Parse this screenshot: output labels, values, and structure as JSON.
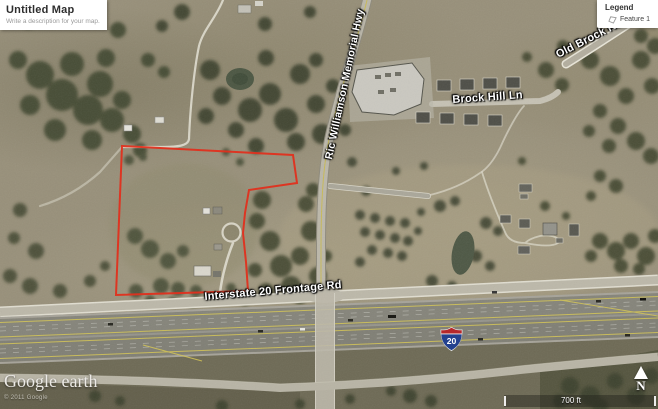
{
  "title_card": {
    "title": "Untitled Map",
    "description": "Write a description for your map."
  },
  "legend": {
    "title": "Legend",
    "items": [
      {
        "label": "Feature 1",
        "icon": "polygon-outline-icon"
      }
    ]
  },
  "map": {
    "road_labels": {
      "ric_williamson_memorial_hwy": "Ric Williamson Memorial Hwy",
      "brock_hill_ln": "Brock Hill Ln",
      "old_brock_rd": "Old Brock Rd",
      "interstate_20_frontage_rd": "Interstate 20 Frontage Rd"
    },
    "interstate_shield": {
      "route_number": "20"
    },
    "feature_outline_color": "#e0301d"
  },
  "attribution": {
    "logo_text": "Google earth",
    "copyright_text": "© 2011 Google"
  },
  "scale_bar": {
    "distance_label": "700 ft"
  },
  "compass": {
    "north_label": "N"
  }
}
